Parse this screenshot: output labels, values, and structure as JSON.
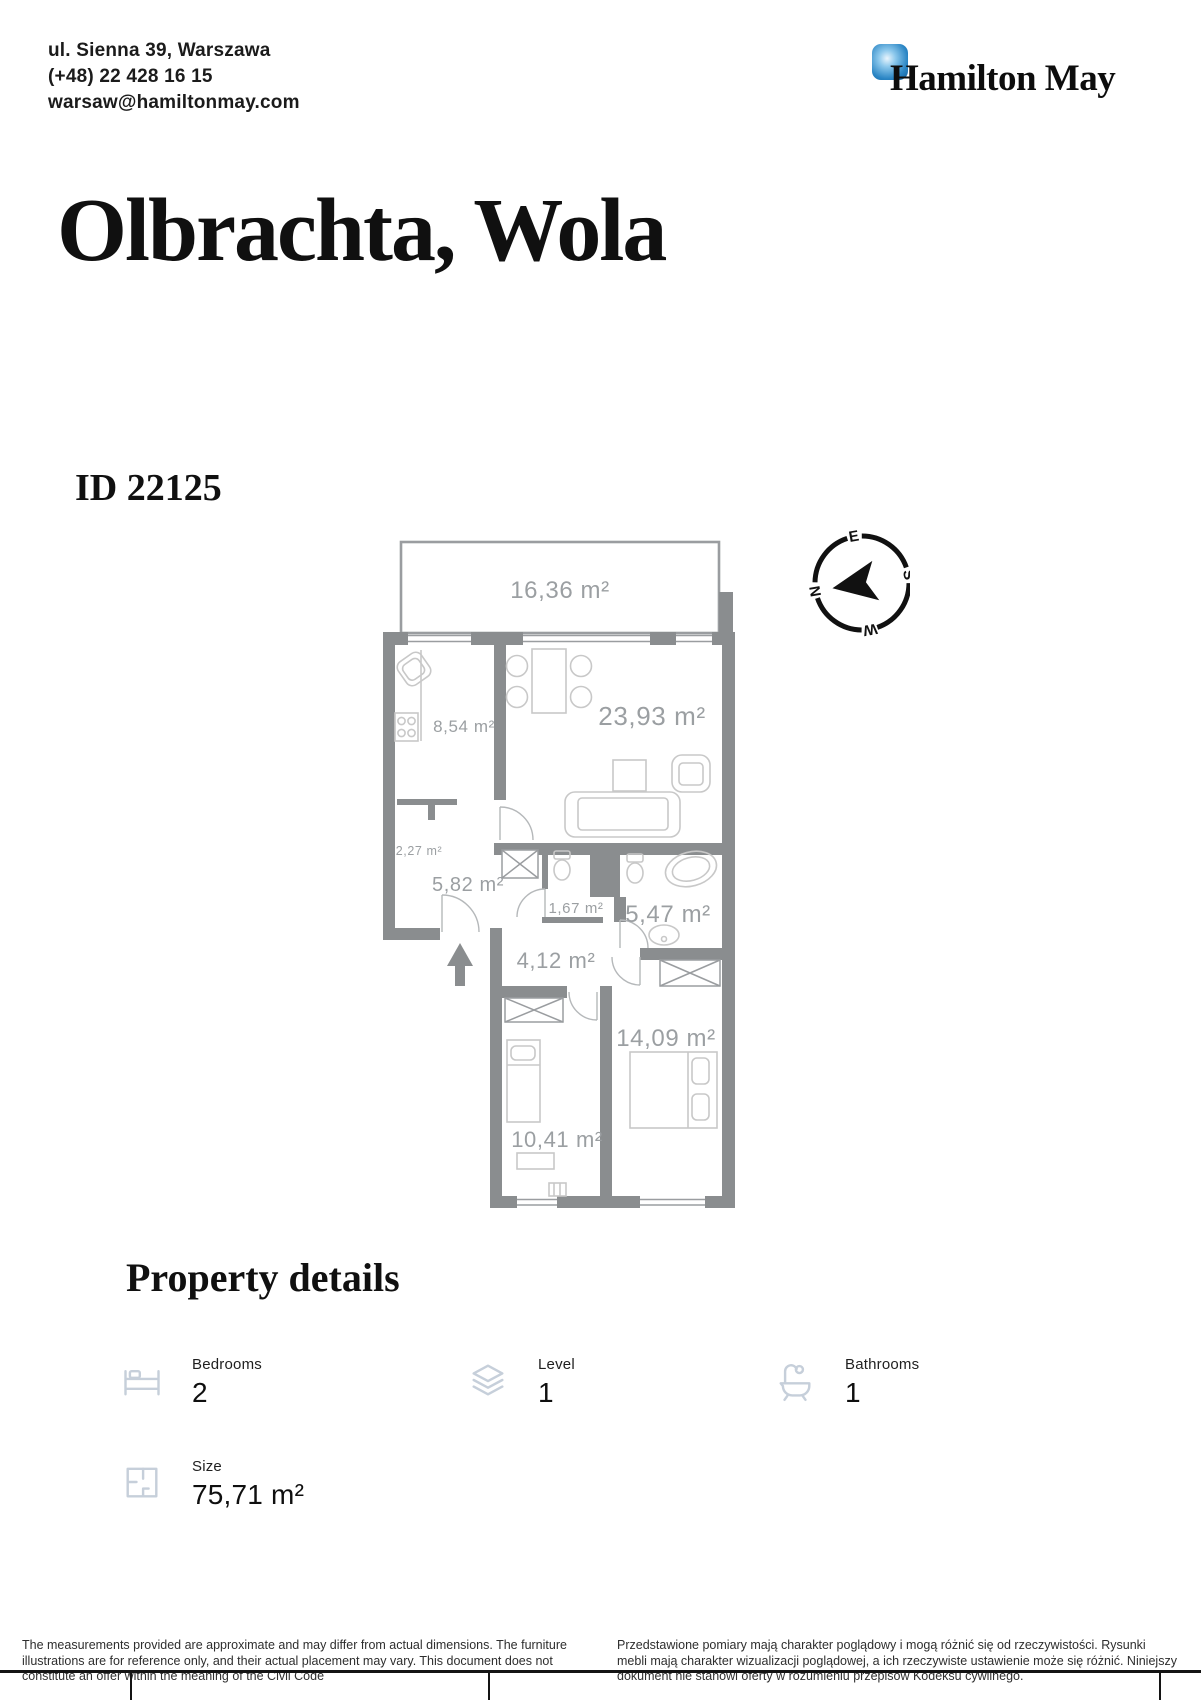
{
  "header": {
    "address": "ul. Sienna 39, Warszawa",
    "phone": "(+48) 22 428 16 15",
    "email": "warsaw@hamiltonmay.com"
  },
  "brand": {
    "name": "Hamilton May",
    "accent_color": "#1b77ba"
  },
  "listing": {
    "title": "Olbrachta, Wola",
    "id": "ID 22125"
  },
  "plan": {
    "wall_color": "#8a8d8f",
    "label_color": "#9b9fa2",
    "rooms": [
      {
        "name": "terrace",
        "area": "16,36 m²"
      },
      {
        "name": "kitchen",
        "area": "8,54 m²"
      },
      {
        "name": "living-room",
        "area": "23,93 m²"
      },
      {
        "name": "closet",
        "area": "2,27 m²"
      },
      {
        "name": "hall",
        "area": "5,82 m²"
      },
      {
        "name": "wc",
        "area": "1,67 m²"
      },
      {
        "name": "bathroom",
        "area": "5,47 m²"
      },
      {
        "name": "corridor",
        "area": "4,12 m²"
      },
      {
        "name": "bedroom-large",
        "area": "14,09 m²"
      },
      {
        "name": "bedroom-small",
        "area": "10,41 m²"
      }
    ],
    "compass": {
      "n": "N",
      "e": "E",
      "s": "S",
      "w": "W"
    }
  },
  "details": {
    "heading": "Property details",
    "items": [
      {
        "icon": "bed-icon",
        "label": "Bedrooms",
        "value": "2"
      },
      {
        "icon": "layers-icon",
        "label": "Level",
        "value": "1"
      },
      {
        "icon": "bathtub-icon",
        "label": "Bathrooms",
        "value": "1"
      },
      {
        "icon": "floorplan-icon",
        "label": "Size",
        "value": "75,71 m²"
      }
    ]
  },
  "footer": {
    "disclaimer_en": "The measurements provided are approximate and may differ from actual dimensions. The furniture illustrations are for reference only, and their actual placement may vary. This document does not constitute an offer within the meaning of the Civil Code",
    "disclaimer_pl": "Przedstawione pomiary mają charakter poglądowy i mogą różnić się od rzeczywistości. Rysunki mebli mają charakter wizualizacji poglądowej, a ich rzeczywiste ustawienie może się różnić. Niniejszy dokument nie stanowi oferty w rozumieniu przepisów Kodeksu cywilnego."
  }
}
